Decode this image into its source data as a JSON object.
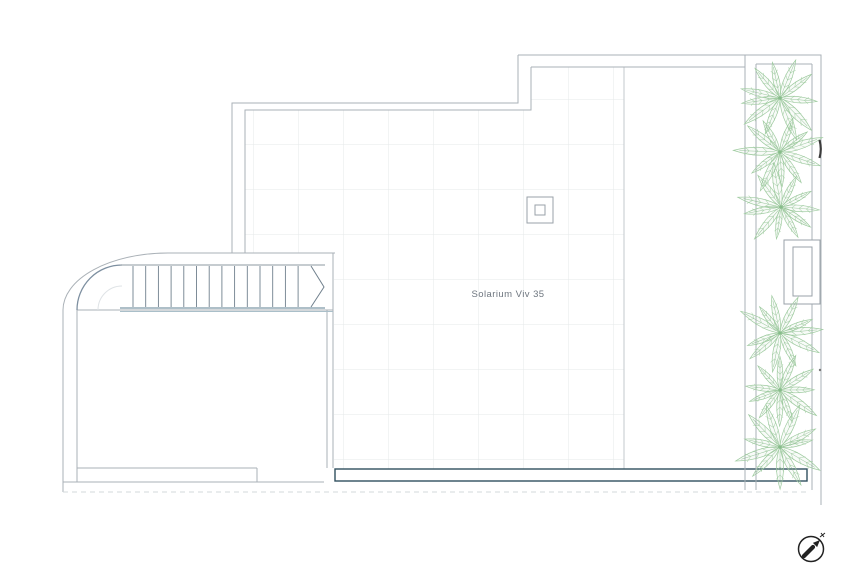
{
  "plan": {
    "room_label": "Solarium Viv 35",
    "colors": {
      "outline": "#aab1b7",
      "outline_dark": "#8e99a2",
      "grid": "#e6e8ea",
      "grid_boundary": "#c3c9cd",
      "stair_line": "#70808d",
      "stair_accent": "#7e99a8",
      "stair_accent_light": "#aabfc9",
      "inner_arc": "#7d8fa0",
      "faint_arc": "#dfe3e6",
      "balustrade": "#31505f",
      "dashed_faint": "#d3d8db",
      "plant": "#9fcba0",
      "plant_dark": "#7fb783",
      "marker_dark": "#3c3c3c",
      "compass": "#222222",
      "label_text": "#6e767f"
    },
    "stairs": {
      "tread_count": 14,
      "tread_start_x": 133,
      "tread_step": 12.7,
      "tread_top_y": 266,
      "tread_bottom_y": 307
    },
    "palms": {
      "radius": 47,
      "frond_count": 11,
      "centers": [
        [
          780,
          98
        ],
        [
          780,
          152
        ],
        [
          781,
          207
        ],
        [
          780,
          333
        ],
        [
          780,
          390
        ],
        [
          780,
          447
        ]
      ]
    }
  }
}
